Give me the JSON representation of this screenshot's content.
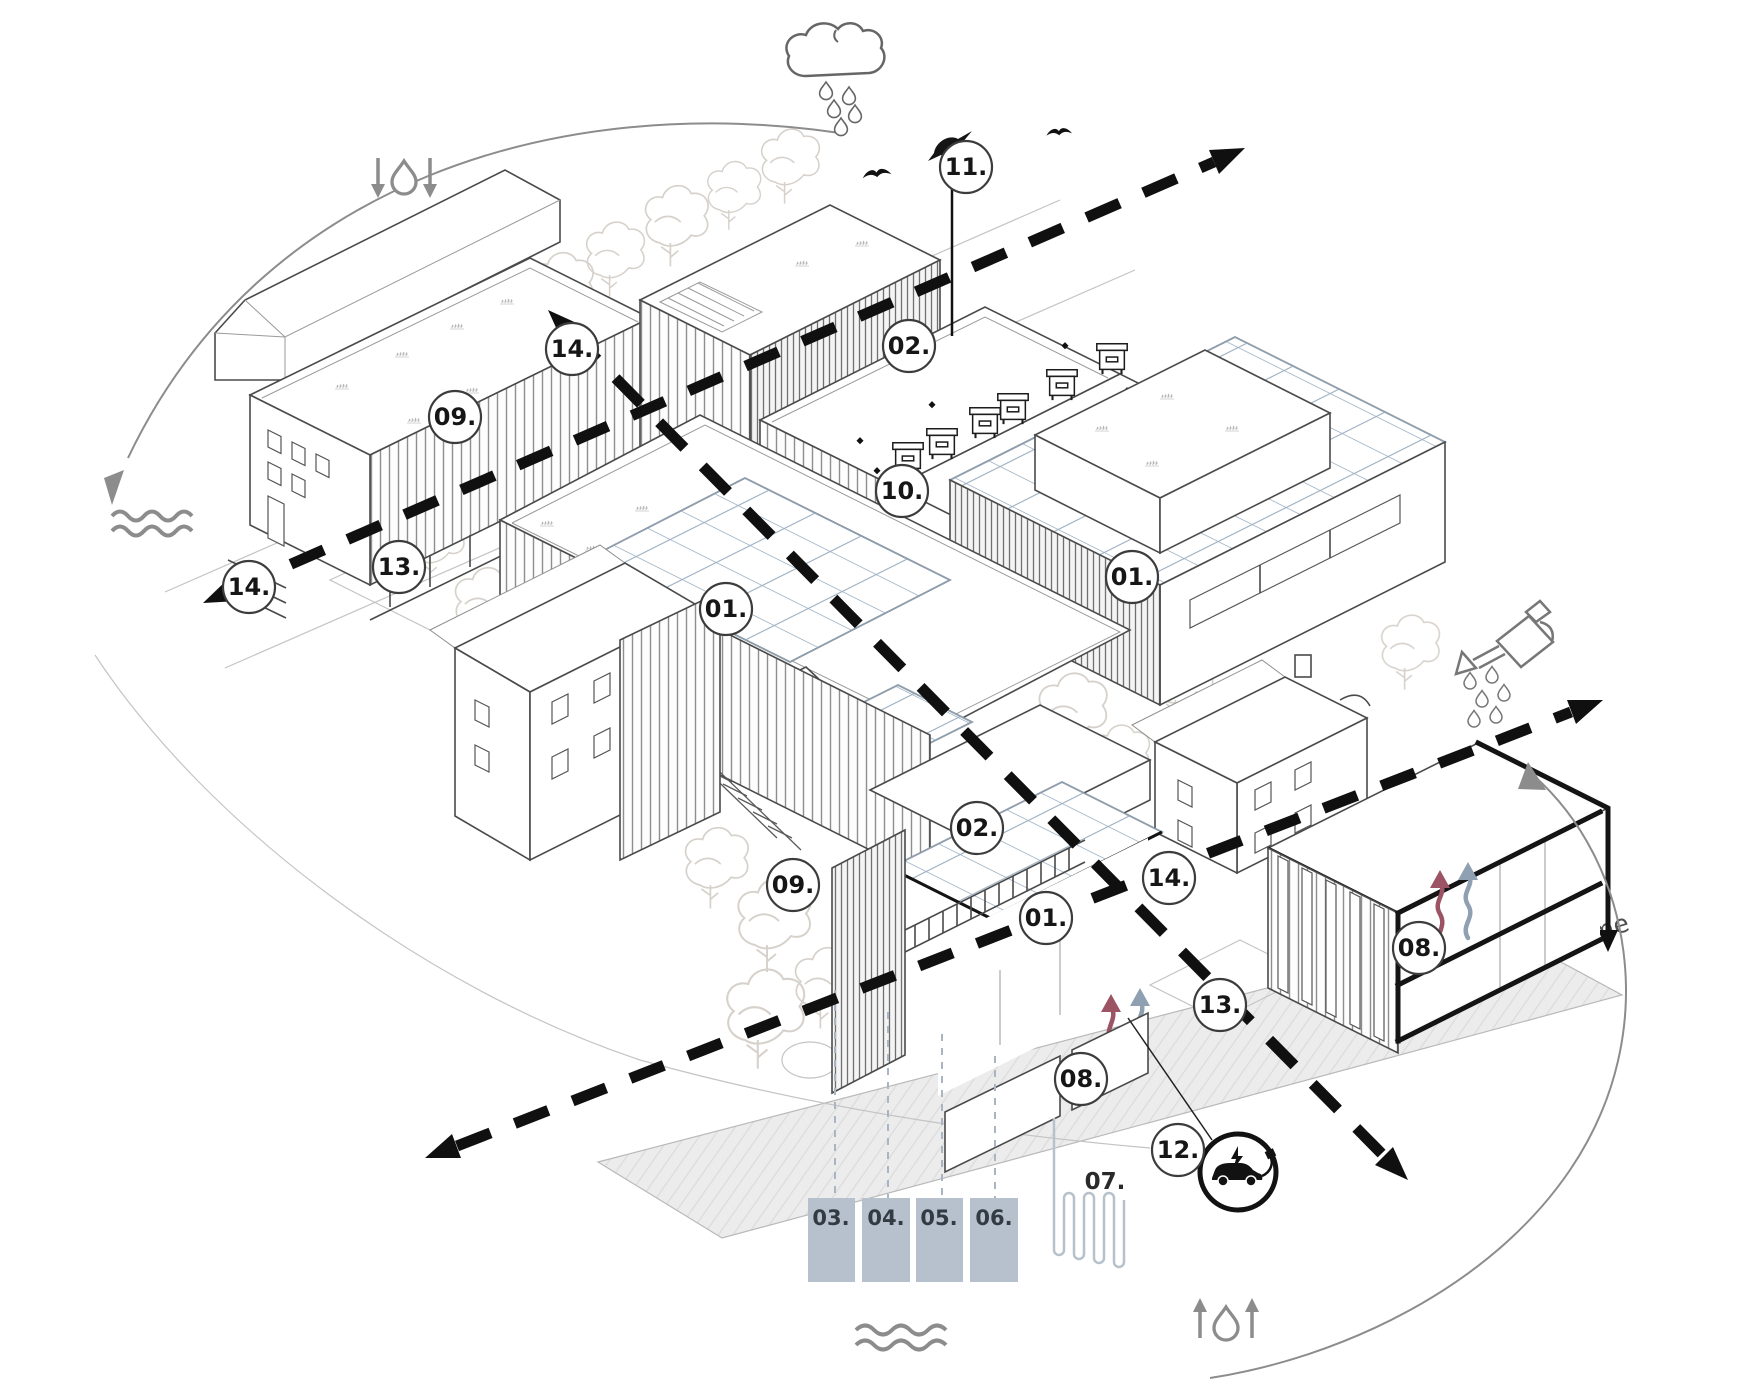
{
  "diagram": {
    "kind": "axonometric-architecture-sustainability-diagram",
    "callouts": [
      {
        "id": "building-09-north",
        "text": "09.",
        "x": 455,
        "y": 417
      },
      {
        "id": "mast-11",
        "text": "11.",
        "x": 966,
        "y": 167
      },
      {
        "id": "roof-02-north",
        "text": "02.",
        "x": 909,
        "y": 346
      },
      {
        "id": "beehives-10",
        "text": "10.",
        "x": 902,
        "y": 491
      },
      {
        "id": "solar-01-east",
        "text": "01.",
        "x": 1132,
        "y": 577
      },
      {
        "id": "solar-01-center",
        "text": "01.",
        "x": 726,
        "y": 609
      },
      {
        "id": "axis-14-northwest",
        "text": "14.",
        "x": 572,
        "y": 349
      },
      {
        "id": "court-13-west",
        "text": "13.",
        "x": 399,
        "y": 567
      },
      {
        "id": "axis-14-west",
        "text": "14.",
        "x": 249,
        "y": 587
      },
      {
        "id": "roof-02-center",
        "text": "02.",
        "x": 977,
        "y": 828
      },
      {
        "id": "axis-14-east",
        "text": "14.",
        "x": 1169,
        "y": 878
      },
      {
        "id": "solar-01-south",
        "text": "01.",
        "x": 1046,
        "y": 918
      },
      {
        "id": "facade-09-center",
        "text": "09.",
        "x": 793,
        "y": 885
      },
      {
        "id": "court-13-east",
        "text": "13.",
        "x": 1220,
        "y": 1005
      },
      {
        "id": "section-08-east",
        "text": "08.",
        "x": 1419,
        "y": 948
      },
      {
        "id": "section-08-south",
        "text": "08.",
        "x": 1081,
        "y": 1079
      },
      {
        "id": "ev-12",
        "text": "12.",
        "x": 1178,
        "y": 1150
      }
    ],
    "plain_labels": [
      {
        "id": "geothermal-07",
        "text": "07.",
        "x": 1105,
        "y": 1181
      }
    ],
    "underground_boxes": [
      {
        "id": "box-03",
        "text": "03."
      },
      {
        "id": "box-04",
        "text": "04."
      },
      {
        "id": "box-05",
        "text": "05."
      },
      {
        "id": "box-06",
        "text": "06."
      }
    ],
    "ground_band": {
      "label": "grunty rodzime"
    },
    "icons": [
      {
        "name": "rain-cloud-icon"
      },
      {
        "name": "infiltration-drop-down-arrows-icon"
      },
      {
        "name": "groundwater-waves-left-icon"
      },
      {
        "name": "bird-on-mast-icon"
      },
      {
        "name": "flying-bird-icon"
      },
      {
        "name": "beehive-icon"
      },
      {
        "name": "watering-can-icon"
      },
      {
        "name": "ev-charging-icon"
      },
      {
        "name": "geothermal-loop-icon"
      },
      {
        "name": "evaporation-drop-up-arrows-icon"
      },
      {
        "name": "groundwater-waves-bottom-icon"
      }
    ],
    "colors": {
      "dashed_axis": "#101010",
      "section_red": "#9c5465",
      "section_blue": "#8fa0b2",
      "underground_box_fill": "#b6c1cd",
      "solar_grid": "#9fb2c3",
      "ground_fill": "#ececec",
      "icon_gray": "#8c8c8c"
    }
  }
}
